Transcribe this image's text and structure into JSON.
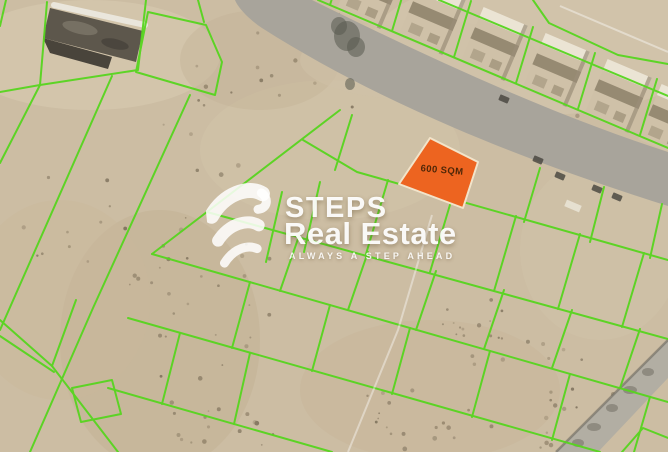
{
  "watermark": {
    "title": "STEPS",
    "subtitle": "Real Estate",
    "tagline": "ALWAYS A STEP AHEAD"
  },
  "map": {
    "colors": {
      "sand": "#ccbda3",
      "plot_line_green": "#57d51f",
      "road_gray": "#a8a49b",
      "side_road_gray": "#b2aea3",
      "side_road_edge": "#6b675f",
      "highlight_orange": "#ED6420",
      "highlight_border": "#F2E4CA",
      "label_text": "#4F2708",
      "villa_wall": "#cfc1a8",
      "villa_roof": "#ebe4d4",
      "building_dark": "#5d574c"
    },
    "plot": {
      "label": "600 SQM",
      "polygon": "430,138 478,162 463,208 399,184"
    },
    "roads": {
      "main_road": "M 235,0 L 312,0 C 430,58 545,112 668,152 L 668,206 C 515,158 375,100 262,28 C 250,20 238,8 235,0 Z",
      "side_road": "668,340 668,378 598,452 556,452",
      "side_road_edge_line": "668,340 556,452"
    },
    "villa_rotation": 23,
    "villas": [
      [
        370,
        -8
      ],
      [
        432,
        18
      ],
      [
        494,
        44
      ],
      [
        556,
        70
      ],
      [
        618,
        96
      ],
      [
        672,
        121
      ]
    ],
    "main_building": {
      "body": "50,8 143,31 136,62 43,38",
      "wing": "43,38 112,57 108,69 50,53",
      "roof_line": "54,5 145,25"
    },
    "road_objects": {
      "tree_blobs": [
        [
          347,
          36,
          13,
          15
        ],
        [
          339,
          26,
          8,
          9
        ],
        [
          356,
          47,
          9,
          10
        ],
        [
          350,
          84,
          5,
          6
        ]
      ],
      "cars": [
        [
          560,
          176
        ],
        [
          597,
          189
        ],
        [
          617,
          197
        ],
        [
          504,
          99
        ],
        [
          538,
          160
        ]
      ],
      "trailer": [
        573,
        206
      ],
      "rubble": [
        [
          648,
          372,
          6,
          4
        ],
        [
          630,
          390,
          7,
          4
        ],
        [
          612,
          408,
          6,
          4
        ],
        [
          594,
          427,
          7,
          4
        ],
        [
          578,
          443,
          6,
          4
        ]
      ]
    },
    "tracks": [
      "432,215 398,330 348,452",
      "560,6 668,52"
    ],
    "green_lines": [
      "439,0 668,96",
      "318,0 668,148",
      "347,-51 330,5",
      "409,-26 392,31",
      "471,1 454,57",
      "533,27 516,83",
      "595,53 578,109",
      "657,79 640,135",
      "533,0 549,23 618,55 668,64",
      "6,0 0,26",
      "47,2 40,85",
      "0,92 40,85 138,70 146,0",
      "148,12 206,25 222,62 215,95 136,72 148,12",
      "204,22 198,0",
      "112,76 0,330",
      "40,85 0,163",
      "190,95 93,308 30,452",
      "0,320 52,366",
      "0,336 54,372",
      "52,366 118,452",
      "76,300 52,366",
      "72,388 112,380 121,414 81,422 72,388",
      "340,110 152,254",
      "303,140 357,172 668,260",
      "207,212 668,339",
      "152,254 668,402",
      "128,318 600,452",
      "108,388 332,452",
      "352,115 335,170",
      "540,168 524,222",
      "604,187 590,242",
      "662,204 650,258",
      "388,180 366,254",
      "452,198 430,272",
      "516,216 494,291",
      "580,234 558,309",
      "644,253 622,327",
      "282,192 266,262",
      "320,182 304,252",
      "300,233 280,291",
      "368,252 348,310",
      "436,271 416,330",
      "504,290 484,349",
      "572,310 552,368",
      "640,329 620,388",
      "250,282 232,348",
      "330,305 312,371",
      "410,328 392,394",
      "490,351 472,417",
      "570,374 552,440",
      "650,397 634,452",
      "180,333 162,404",
      "250,353 234,424",
      "622,452 643,428 668,438"
    ]
  }
}
